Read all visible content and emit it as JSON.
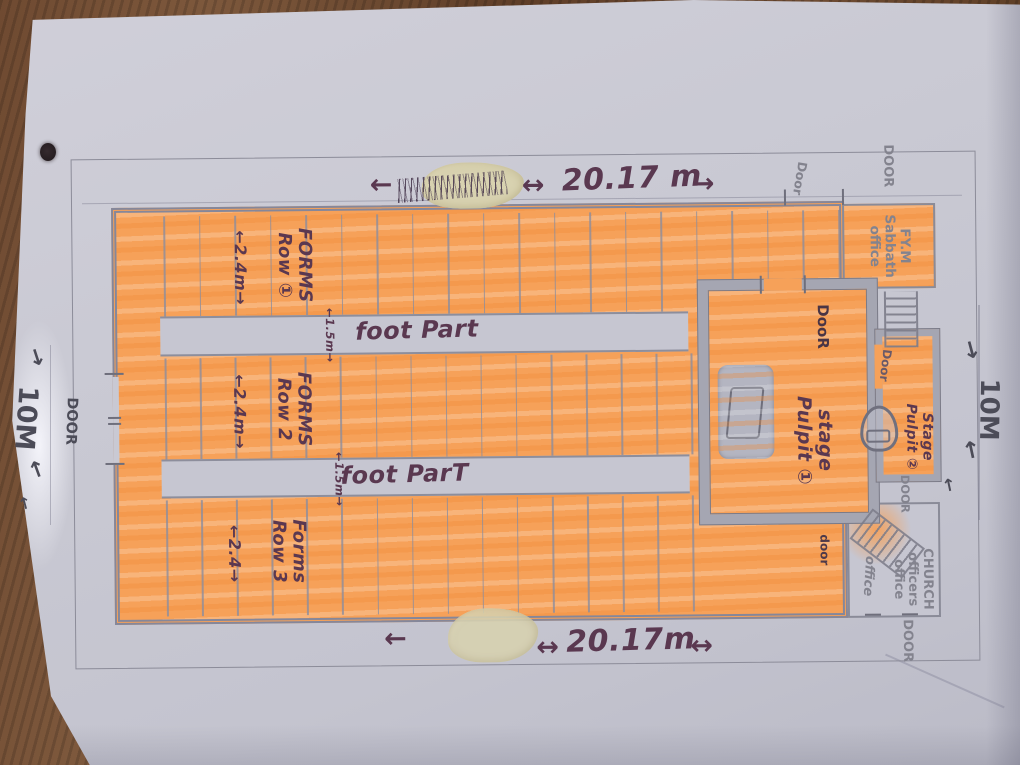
{
  "dimensions": {
    "top": {
      "arrow_left": "←",
      "arrow_mid": "↔",
      "value": "20.17 m",
      "arrow_right": "→"
    },
    "bottom": {
      "arrow_left": "←",
      "arrow_mid": "↔",
      "value": "20.17m",
      "arrow_right": "↔"
    },
    "left": {
      "value": "10M",
      "arrow_top": "↓",
      "arrow_bottom": "↑",
      "arrow_extra": "↑"
    },
    "right": {
      "value": "10M",
      "arrow_top": "↓",
      "arrow_bottom": "↑",
      "arrow_extra": "↑"
    }
  },
  "hall": {
    "rows": [
      {
        "line1": "FORMS",
        "line2": "Row ①",
        "width": "←2.4m→",
        "benches": 20
      },
      {
        "line1": "FORMS",
        "line2": "Row 2",
        "width": "←2.4m→",
        "benches": 16
      },
      {
        "line1": "Forms",
        "line2": "Row 3",
        "width": "←2.4→",
        "benches": 16
      }
    ],
    "footpaths": [
      {
        "label": "foot Part",
        "width": "←1.5m→"
      },
      {
        "label": "foot ParT",
        "width": "←1.5m→"
      }
    ]
  },
  "stage1": {
    "line1": "stage",
    "line2": "Pulpit ①",
    "door_label": "DooR"
  },
  "stage2": {
    "line1": "Stage",
    "line2": "Pulpit ②",
    "door_label": "Door",
    "lower_door_label": "DOOR"
  },
  "rooms": {
    "sabbath": {
      "line1": "FY.M",
      "line2": "Sabbath",
      "line3": "office"
    },
    "church": {
      "line1": "CHURCH",
      "line2": "officers",
      "line3": "office"
    },
    "office_note": "office"
  },
  "doors": {
    "left": "DOOR",
    "top": "Door",
    "top_right": "DOOR",
    "stage_bottom": "door",
    "bottom_right": "DOOR"
  },
  "colors": {
    "highlighter": "#f6a159",
    "marker_ink": "#5a3850",
    "pencil": "#83838e",
    "paper": "#c9c9d3",
    "wood": "#6f4a31"
  }
}
